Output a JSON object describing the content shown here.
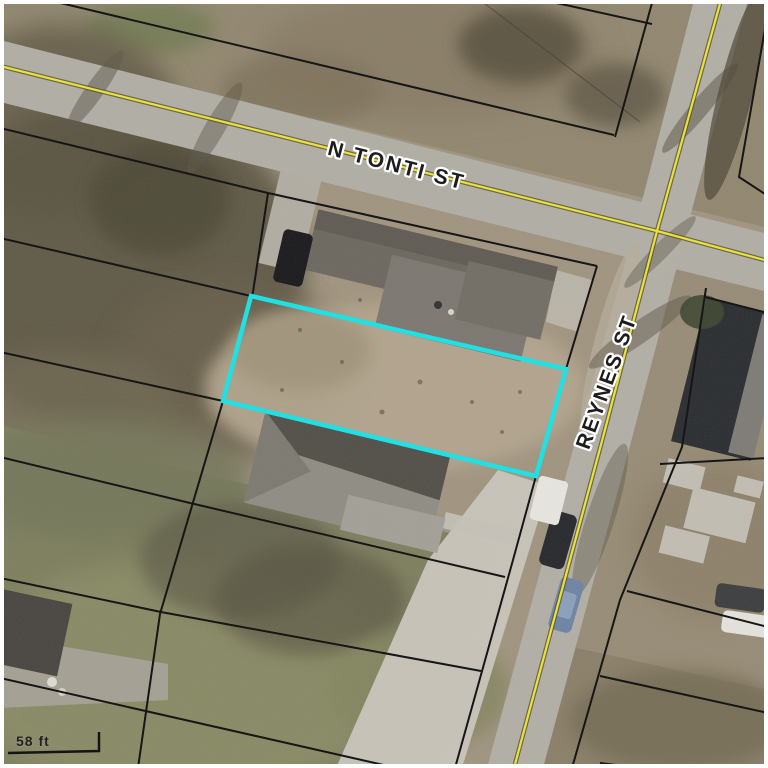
{
  "map": {
    "description": "Aerial parcel map with highlighted vacant lot at N Tonti St and Reynes St",
    "streets": [
      {
        "name": "N TONTI ST"
      },
      {
        "name": "REYNES ST"
      }
    ],
    "scale_bar": {
      "label": "58 ft"
    },
    "highlighted_parcel": {
      "outline_color": "#1fe1e4",
      "points": "251,296 566,369 536,476 223,401"
    },
    "centerlines": {
      "color": "#e9e23b",
      "casing_color": "#55502e",
      "n_tonti_points": "0,66 280,136 657,231 768,261",
      "reynes_points": "721,0 657,231 602,441 514,768"
    },
    "parcel_lines": {
      "color": "#161616"
    }
  }
}
